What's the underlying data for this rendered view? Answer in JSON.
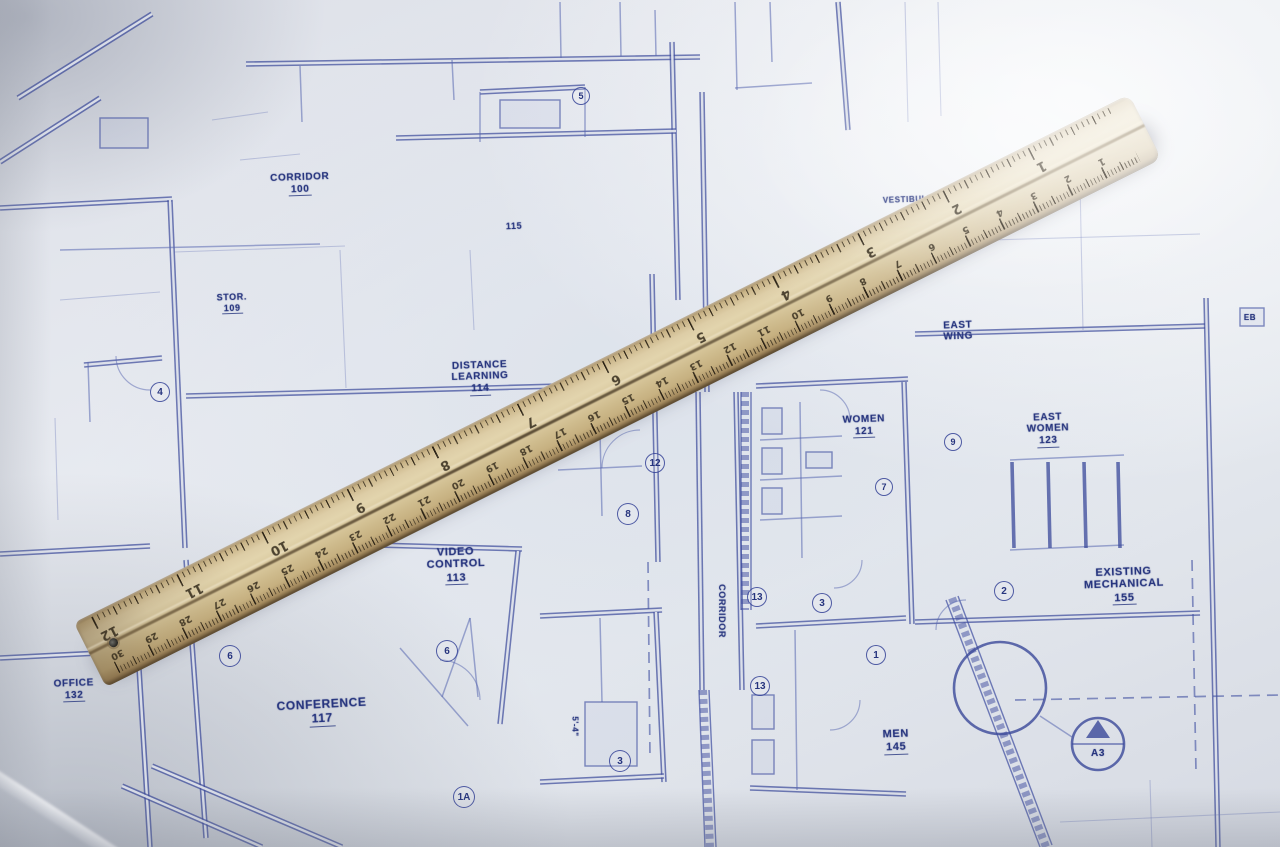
{
  "scene": {
    "description": "Photograph of a blueprint architectural floor plan with a wooden ruler lying diagonally across it",
    "paper_color": "#e4e8ee",
    "ink_color": "#2e3d94",
    "text_color": "#26347e"
  },
  "blueprint": {
    "labels": [
      {
        "lines": [
          "CORRIDOR"
        ],
        "num": "100",
        "x": 300,
        "y": 172,
        "size": 10,
        "rot": -2
      },
      {
        "lines": [
          "115"
        ],
        "num": "",
        "x": 514,
        "y": 221,
        "size": 9,
        "rot": -2
      },
      {
        "lines": [
          "VESTIBULE"
        ],
        "num": "",
        "x": 908,
        "y": 196,
        "size": 8,
        "rot": -2
      },
      {
        "lines": [
          "STOR."
        ],
        "num": "109",
        "x": 232,
        "y": 292,
        "size": 9,
        "rot": -2
      },
      {
        "lines": [
          "DISTANCE",
          "LEARNING"
        ],
        "num": "114",
        "x": 480,
        "y": 360,
        "size": 10,
        "rot": -2
      },
      {
        "lines": [
          "VIDEO",
          "CONTROL"
        ],
        "num": "113",
        "x": 456,
        "y": 546,
        "size": 11,
        "rot": -2
      },
      {
        "lines": [
          "CONFERENCE"
        ],
        "num": "117",
        "x": 322,
        "y": 698,
        "size": 12,
        "rot": -3
      },
      {
        "lines": [
          "WOMEN"
        ],
        "num": "121",
        "x": 864,
        "y": 414,
        "size": 10,
        "rot": -2
      },
      {
        "lines": [
          "EAST",
          "WOMEN"
        ],
        "num": "123",
        "x": 1048,
        "y": 412,
        "size": 10,
        "rot": -2
      },
      {
        "lines": [
          "MEN"
        ],
        "num": "145",
        "x": 896,
        "y": 728,
        "size": 11,
        "rot": -2
      },
      {
        "lines": [
          "EXISTING",
          "MECHANICAL"
        ],
        "num": "155",
        "x": 1124,
        "y": 566,
        "size": 11,
        "rot": -2
      },
      {
        "lines": [
          "CORRIDOR"
        ],
        "num": "",
        "x": 722,
        "y": 606,
        "size": 9,
        "rot": 90
      },
      {
        "lines": [
          "EAST",
          "WING"
        ],
        "num": "",
        "x": 958,
        "y": 320,
        "size": 10,
        "rot": -2
      },
      {
        "lines": [
          "OFFICE"
        ],
        "num": "132",
        "x": 74,
        "y": 678,
        "size": 10,
        "rot": -2
      },
      {
        "lines": [
          "5'-4\""
        ],
        "num": "",
        "x": 574,
        "y": 722,
        "size": 8,
        "rot": 90
      },
      {
        "lines": [
          "EB"
        ],
        "num": "",
        "x": 1250,
        "y": 314,
        "size": 8,
        "rot": 0
      },
      {
        "lines": [
          "A3"
        ],
        "num": "",
        "x": 1098,
        "y": 748,
        "size": 10,
        "rot": 0
      }
    ],
    "tags": [
      {
        "n": "4",
        "x": 160,
        "y": 392,
        "r": 10
      },
      {
        "n": "6",
        "x": 230,
        "y": 656,
        "r": 11
      },
      {
        "n": "6",
        "x": 447,
        "y": 651,
        "r": 11
      },
      {
        "n": "8",
        "x": 628,
        "y": 514,
        "r": 11
      },
      {
        "n": "12",
        "x": 655,
        "y": 463,
        "r": 10
      },
      {
        "n": "3",
        "x": 822,
        "y": 603,
        "r": 10
      },
      {
        "n": "13",
        "x": 757,
        "y": 597,
        "r": 10
      },
      {
        "n": "1",
        "x": 876,
        "y": 655,
        "r": 10
      },
      {
        "n": "13",
        "x": 760,
        "y": 686,
        "r": 10
      },
      {
        "n": "3",
        "x": 620,
        "y": 761,
        "r": 11
      },
      {
        "n": "1A",
        "x": 464,
        "y": 797,
        "r": 11
      },
      {
        "n": "2",
        "x": 1004,
        "y": 591,
        "r": 10
      },
      {
        "n": "9",
        "x": 953,
        "y": 442,
        "r": 9
      },
      {
        "n": "7",
        "x": 884,
        "y": 487,
        "r": 9
      },
      {
        "n": "5",
        "x": 581,
        "y": 96,
        "r": 9
      }
    ],
    "section_marker": {
      "label": "A3"
    }
  },
  "ruler": {
    "wood_color": "#d8c79c",
    "tick_color": "#32291a",
    "inch_numbers": [
      "1",
      "2",
      "3",
      "4",
      "5",
      "6",
      "7",
      "8",
      "9",
      "10",
      "11",
      "12"
    ],
    "cm_numbers": [
      "1",
      "2",
      "3",
      "4",
      "5",
      "6",
      "7",
      "8",
      "9",
      "10",
      "11",
      "12",
      "13",
      "14",
      "15",
      "16",
      "17",
      "18",
      "19",
      "20",
      "21",
      "22",
      "23",
      "24",
      "25",
      "26",
      "27",
      "28",
      "29",
      "30"
    ]
  }
}
